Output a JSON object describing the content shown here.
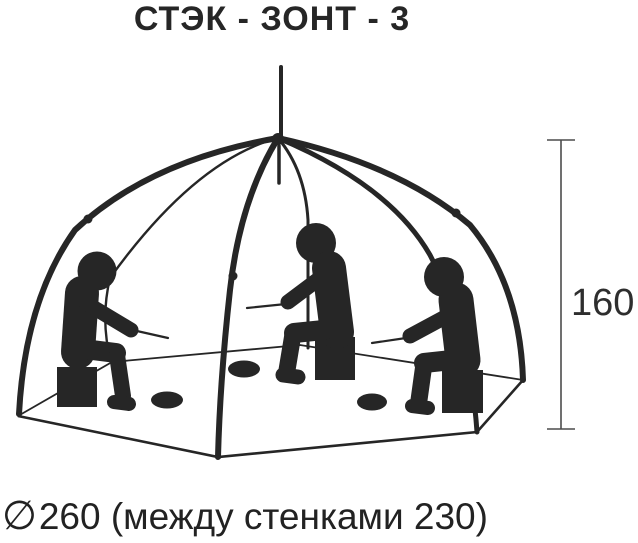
{
  "title": "СТЭК - ЗОНТ - 3",
  "diagram": {
    "type": "ice-fishing umbrella tent, wireframe illustration",
    "height_label": "160",
    "diameter_symbol": "∅",
    "diameter_label": "260 (между стенками 230)",
    "people_count": 3,
    "ice_holes_count": 3,
    "colors": {
      "ink": "#262626",
      "dimension_line": "#4c4c4c",
      "background": "#ffffff"
    }
  }
}
